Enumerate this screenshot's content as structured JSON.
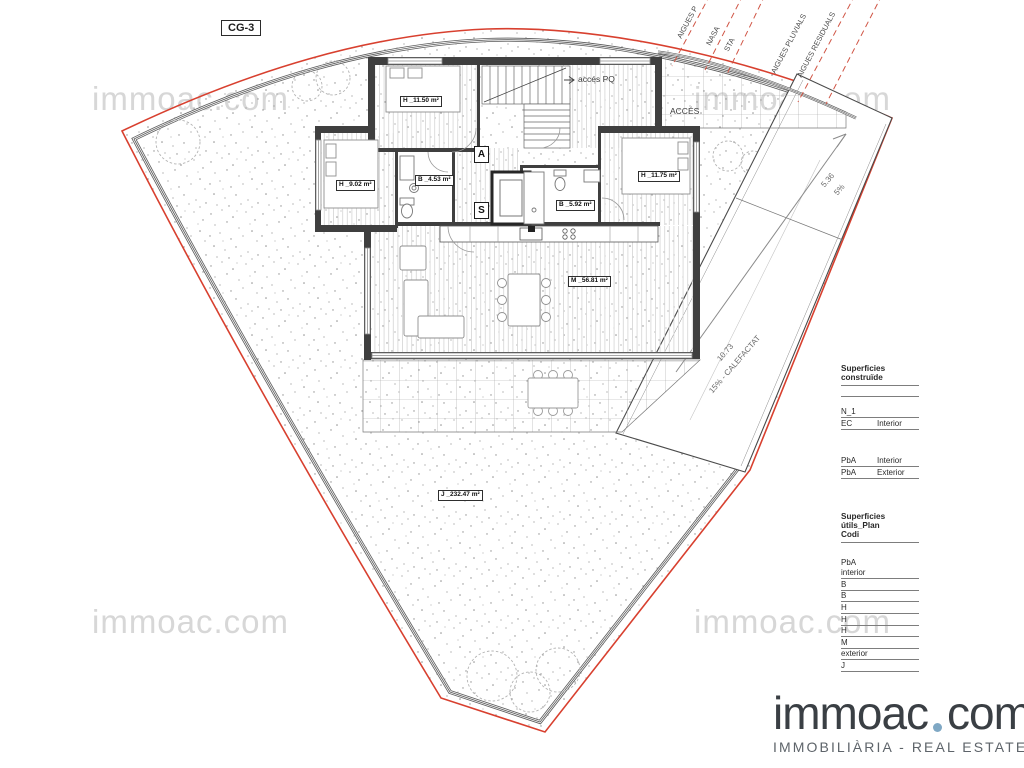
{
  "sheet": {
    "code": "CG-3"
  },
  "watermark": {
    "text": "immoac.com"
  },
  "plan": {
    "rooms": [
      {
        "id": "h1",
        "label": "H _11.50 m²"
      },
      {
        "id": "h2",
        "label": "H _9.02 m²"
      },
      {
        "id": "b1",
        "label": "B _4.53 m²"
      },
      {
        "id": "b2",
        "label": "B _5.92 m²"
      },
      {
        "id": "h3",
        "label": "H _11.75 m²"
      },
      {
        "id": "m",
        "label": "M _56.81 m²"
      },
      {
        "id": "j",
        "label": "J _232.47 m²"
      }
    ],
    "letter_a": "A",
    "letter_s": "S",
    "access_pq": "accés PQ",
    "access": "ACCÉS",
    "ramp": {
      "upper_length": "5.36",
      "upper_slope": "5%",
      "lower_length": "10.73",
      "lower_slope": "15% - CALEFACTAT"
    },
    "utilities": [
      "AIGUES P",
      "NASA",
      "STA",
      "AIGUES PLUVIALS",
      "AIGUES RESIDUALS"
    ]
  },
  "tables": {
    "built": {
      "title": "Superficies construïde",
      "rows": [
        [
          "N_1",
          ""
        ],
        [
          "EC",
          "Interior"
        ],
        [
          "PbA",
          "Interior"
        ],
        [
          "PbA",
          "Exterior"
        ]
      ]
    },
    "useful": {
      "title": "Superficies útils_Plan",
      "code_header": "Codi",
      "rows": [
        "PbA",
        "interior",
        "B",
        "B",
        "H",
        "H",
        "H",
        "M",
        "exterior",
        "J"
      ]
    }
  },
  "logo": {
    "brand_left": "immoac",
    "brand_right": "com",
    "tagline": "IMMOBILIÀRIA - REAL ESTATE"
  },
  "colors": {
    "boundary_red": "#d8402f",
    "wall_dark": "#3f3f3f",
    "watermark_gray": "#d7d7d7",
    "logo_text": "#3a3f44",
    "logo_dot_blue": "#7fa8c4",
    "logo_tagline_gray": "#5e646a"
  }
}
